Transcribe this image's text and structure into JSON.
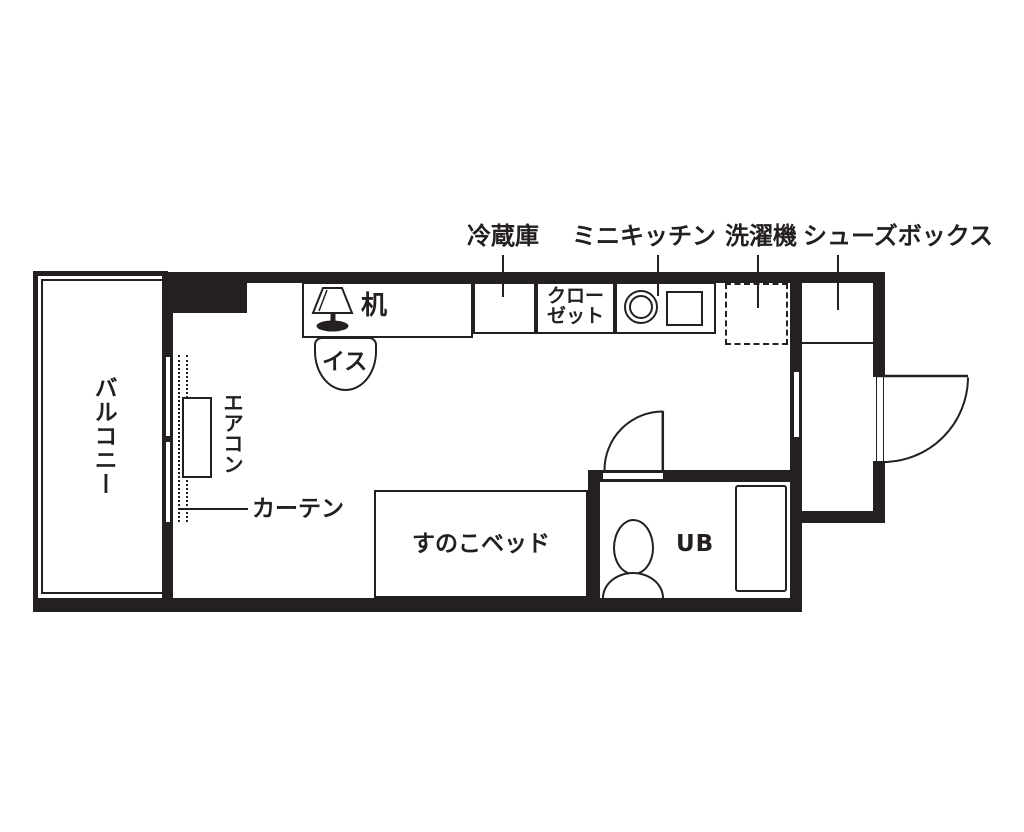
{
  "title": "ワンルーム間取り図 (one-room apartment floor plan)",
  "colors": {
    "wall": "#242021",
    "background": "#ffffff"
  },
  "top_labels": {
    "refrigerator": "冷蔵庫",
    "mini_kitchen": "ミニキッチン",
    "washing_machine": "洗濯機",
    "shoe_box": "シューズボックス"
  },
  "room_labels": {
    "balcony": "バルコニー",
    "air_conditioner": "エアコン",
    "curtain": "カーテン",
    "desk": "机",
    "chair": "イス",
    "closet": {
      "line1": "クロー",
      "line2": "ゼット"
    },
    "slatted_bed": "すのこベッド",
    "unit_bath": "UB"
  },
  "icons": {
    "lamp": "desk-lamp-icon",
    "burner": "kitchen-burner-icon",
    "sink": "kitchen-sink-icon",
    "toilet": "toilet-icon",
    "window": "sliding-window-symbol",
    "doors": "door-swing-symbol"
  }
}
